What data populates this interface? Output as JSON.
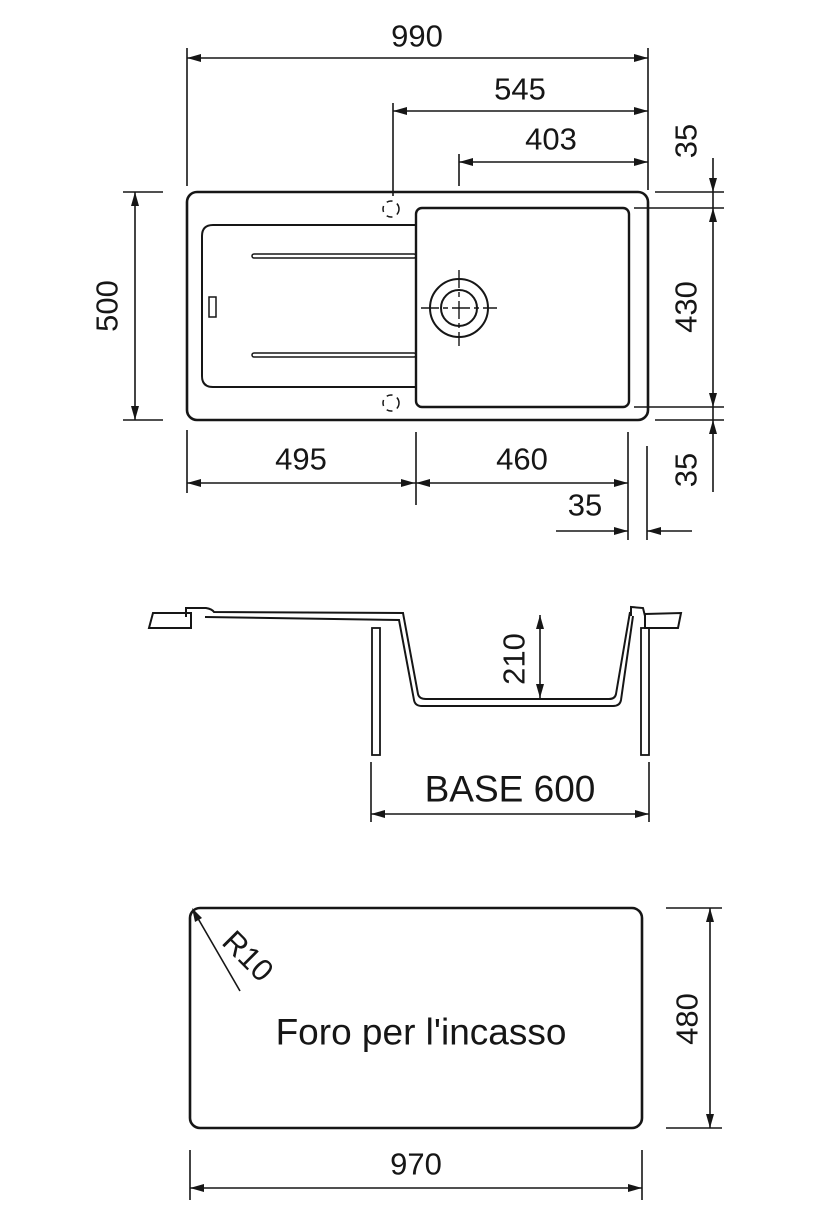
{
  "drawing": {
    "type": "sink-installation-technical-drawing",
    "line_color": "#161616",
    "background": "#ffffff"
  },
  "labels": {
    "w990": "990",
    "w545": "545",
    "w403": "403",
    "h35_top": "35",
    "h500": "500",
    "h430": "430",
    "h35_bottom_v": "35",
    "w495": "495",
    "w460": "460",
    "w35_bottom": "35",
    "h210": "210",
    "base600": "BASE 600",
    "r10": "R10",
    "foro": "Foro per l'incasso",
    "h480": "480",
    "w970": "970"
  }
}
